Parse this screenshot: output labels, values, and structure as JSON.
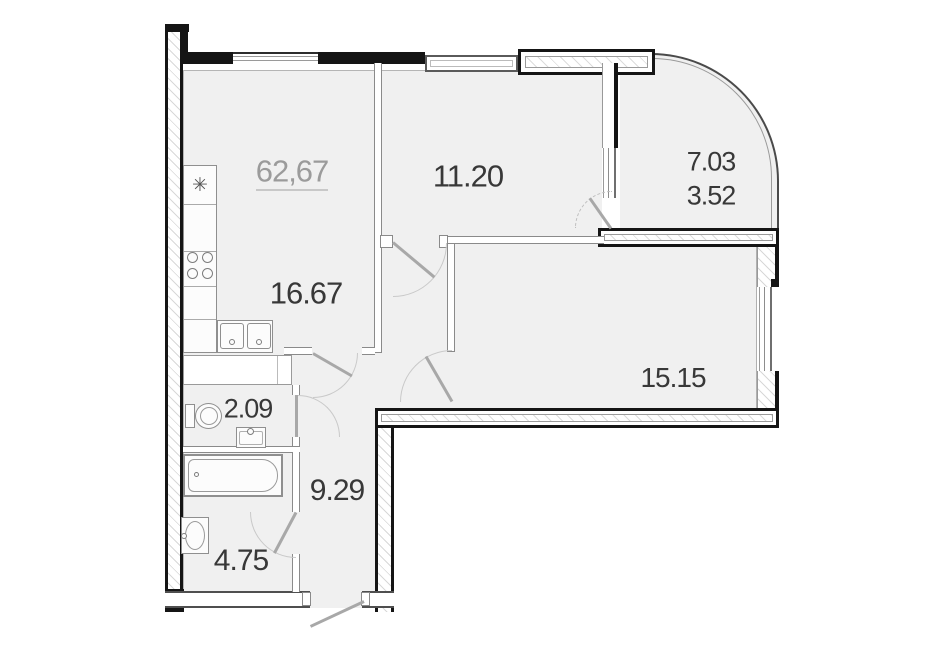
{
  "plan": {
    "labels": {
      "total_area": "62,67",
      "living_room": "11.20",
      "kitchen_living": "16.67",
      "bedroom": "15.15",
      "balcony_full": "7.03",
      "balcony_reduced": "3.52",
      "wc": "2.09",
      "hallway": "9.29",
      "bathroom": "4.75"
    },
    "symbols": {
      "stove": "✳"
    },
    "colors": {
      "wall": "#151515",
      "room_fill": "#f0f0f0",
      "partition_line": "#8a8a8a",
      "label_dark": "#383838",
      "label_muted": "#9b9b9b"
    }
  }
}
